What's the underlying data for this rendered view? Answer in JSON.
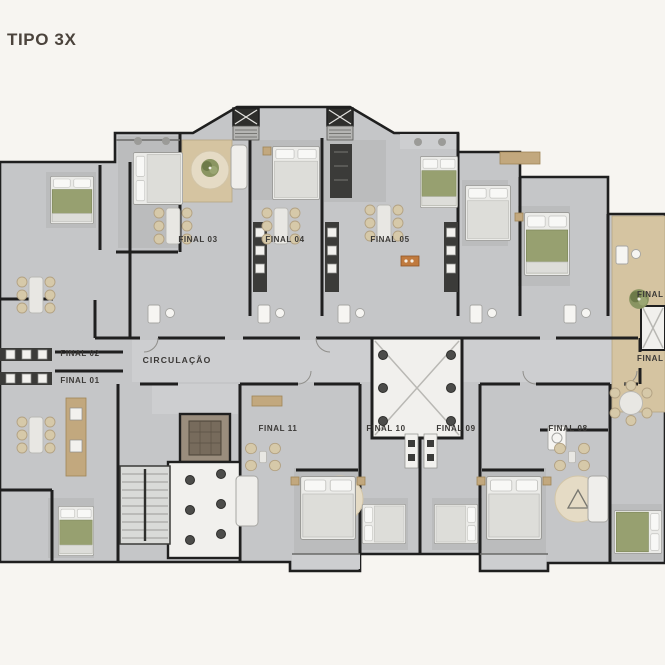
{
  "title": "TIPO 3X",
  "plan": {
    "circulation_label": "CIRCULAÇÃO",
    "units": [
      {
        "id": "final-01",
        "label": "FINAL 01"
      },
      {
        "id": "final-02",
        "label": "FINAL 02"
      },
      {
        "id": "final-03",
        "label": "FINAL 03"
      },
      {
        "id": "final-04",
        "label": "FINAL 04"
      },
      {
        "id": "final-05",
        "label": "FINAL 05"
      },
      {
        "id": "final-06",
        "label": "FINAL 06"
      },
      {
        "id": "final-07",
        "label": "FINAL 07"
      },
      {
        "id": "final-08",
        "label": "FINAL 08"
      },
      {
        "id": "final-09",
        "label": "FINAL 09"
      },
      {
        "id": "final-10",
        "label": "FINAL 10"
      },
      {
        "id": "final-11",
        "label": "FINAL 11"
      }
    ]
  },
  "colors": {
    "background": "#f7f5f1",
    "floor": "#c5c6c8",
    "floor_light": "#cdced0",
    "floor_dark": "#b7b8ba",
    "wall": "#1f1f1f",
    "white_room": "#f1f0ed",
    "wood": "#d5c4a1",
    "wood_dark": "#c2a87e",
    "bed_white": "#ebebe8",
    "bed_olive": "#97a070",
    "plant_green": "#7d8a57",
    "rug_beige": "#e5dbc5",
    "label_text": "#3a3836",
    "title_text": "#4b433c"
  }
}
